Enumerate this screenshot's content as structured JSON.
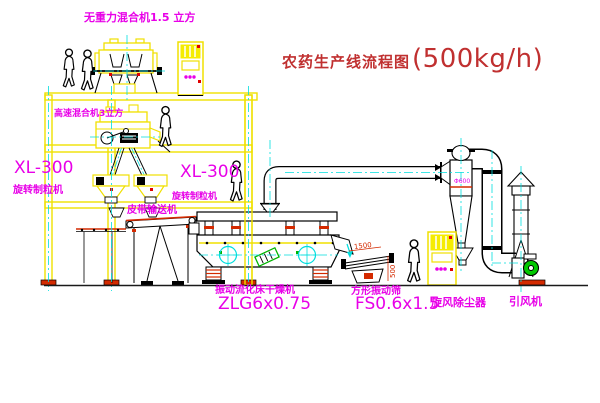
{
  "diagram": {
    "title_main": "农药生产线流程图",
    "title_capacity": "(500kg/h)",
    "labels": {
      "gravity_mixer": "无重力混合机1.5 立方",
      "high_speed_mixer": "高速混合机3立方",
      "granulator_left_model": "XL-300",
      "granulator_left_name": "旋转制粒机",
      "granulator_right_model": "XL-300",
      "granulator_right_name": "旋转制粒机",
      "belt_conveyor": "皮带输送机",
      "dryer_name": "振动流化床干燥机",
      "dryer_model": "ZLG6x0.75",
      "screen_name": "方形振动筛",
      "screen_model": "FS0.6x1.5",
      "cyclone_name": "旋风除尘器",
      "fan_name": "引风机"
    },
    "dimensions": {
      "cyclone_diameter": "Φ600",
      "screen_length": "1500",
      "screen_height": "500"
    },
    "colors": {
      "machine_yellow": "#f0e000",
      "centerline_cyan": "#00dede",
      "label_magenta": "#e800e8",
      "title_red": "#c03030",
      "dimension_red": "#d42a00",
      "fan_green": "#00c800"
    }
  }
}
